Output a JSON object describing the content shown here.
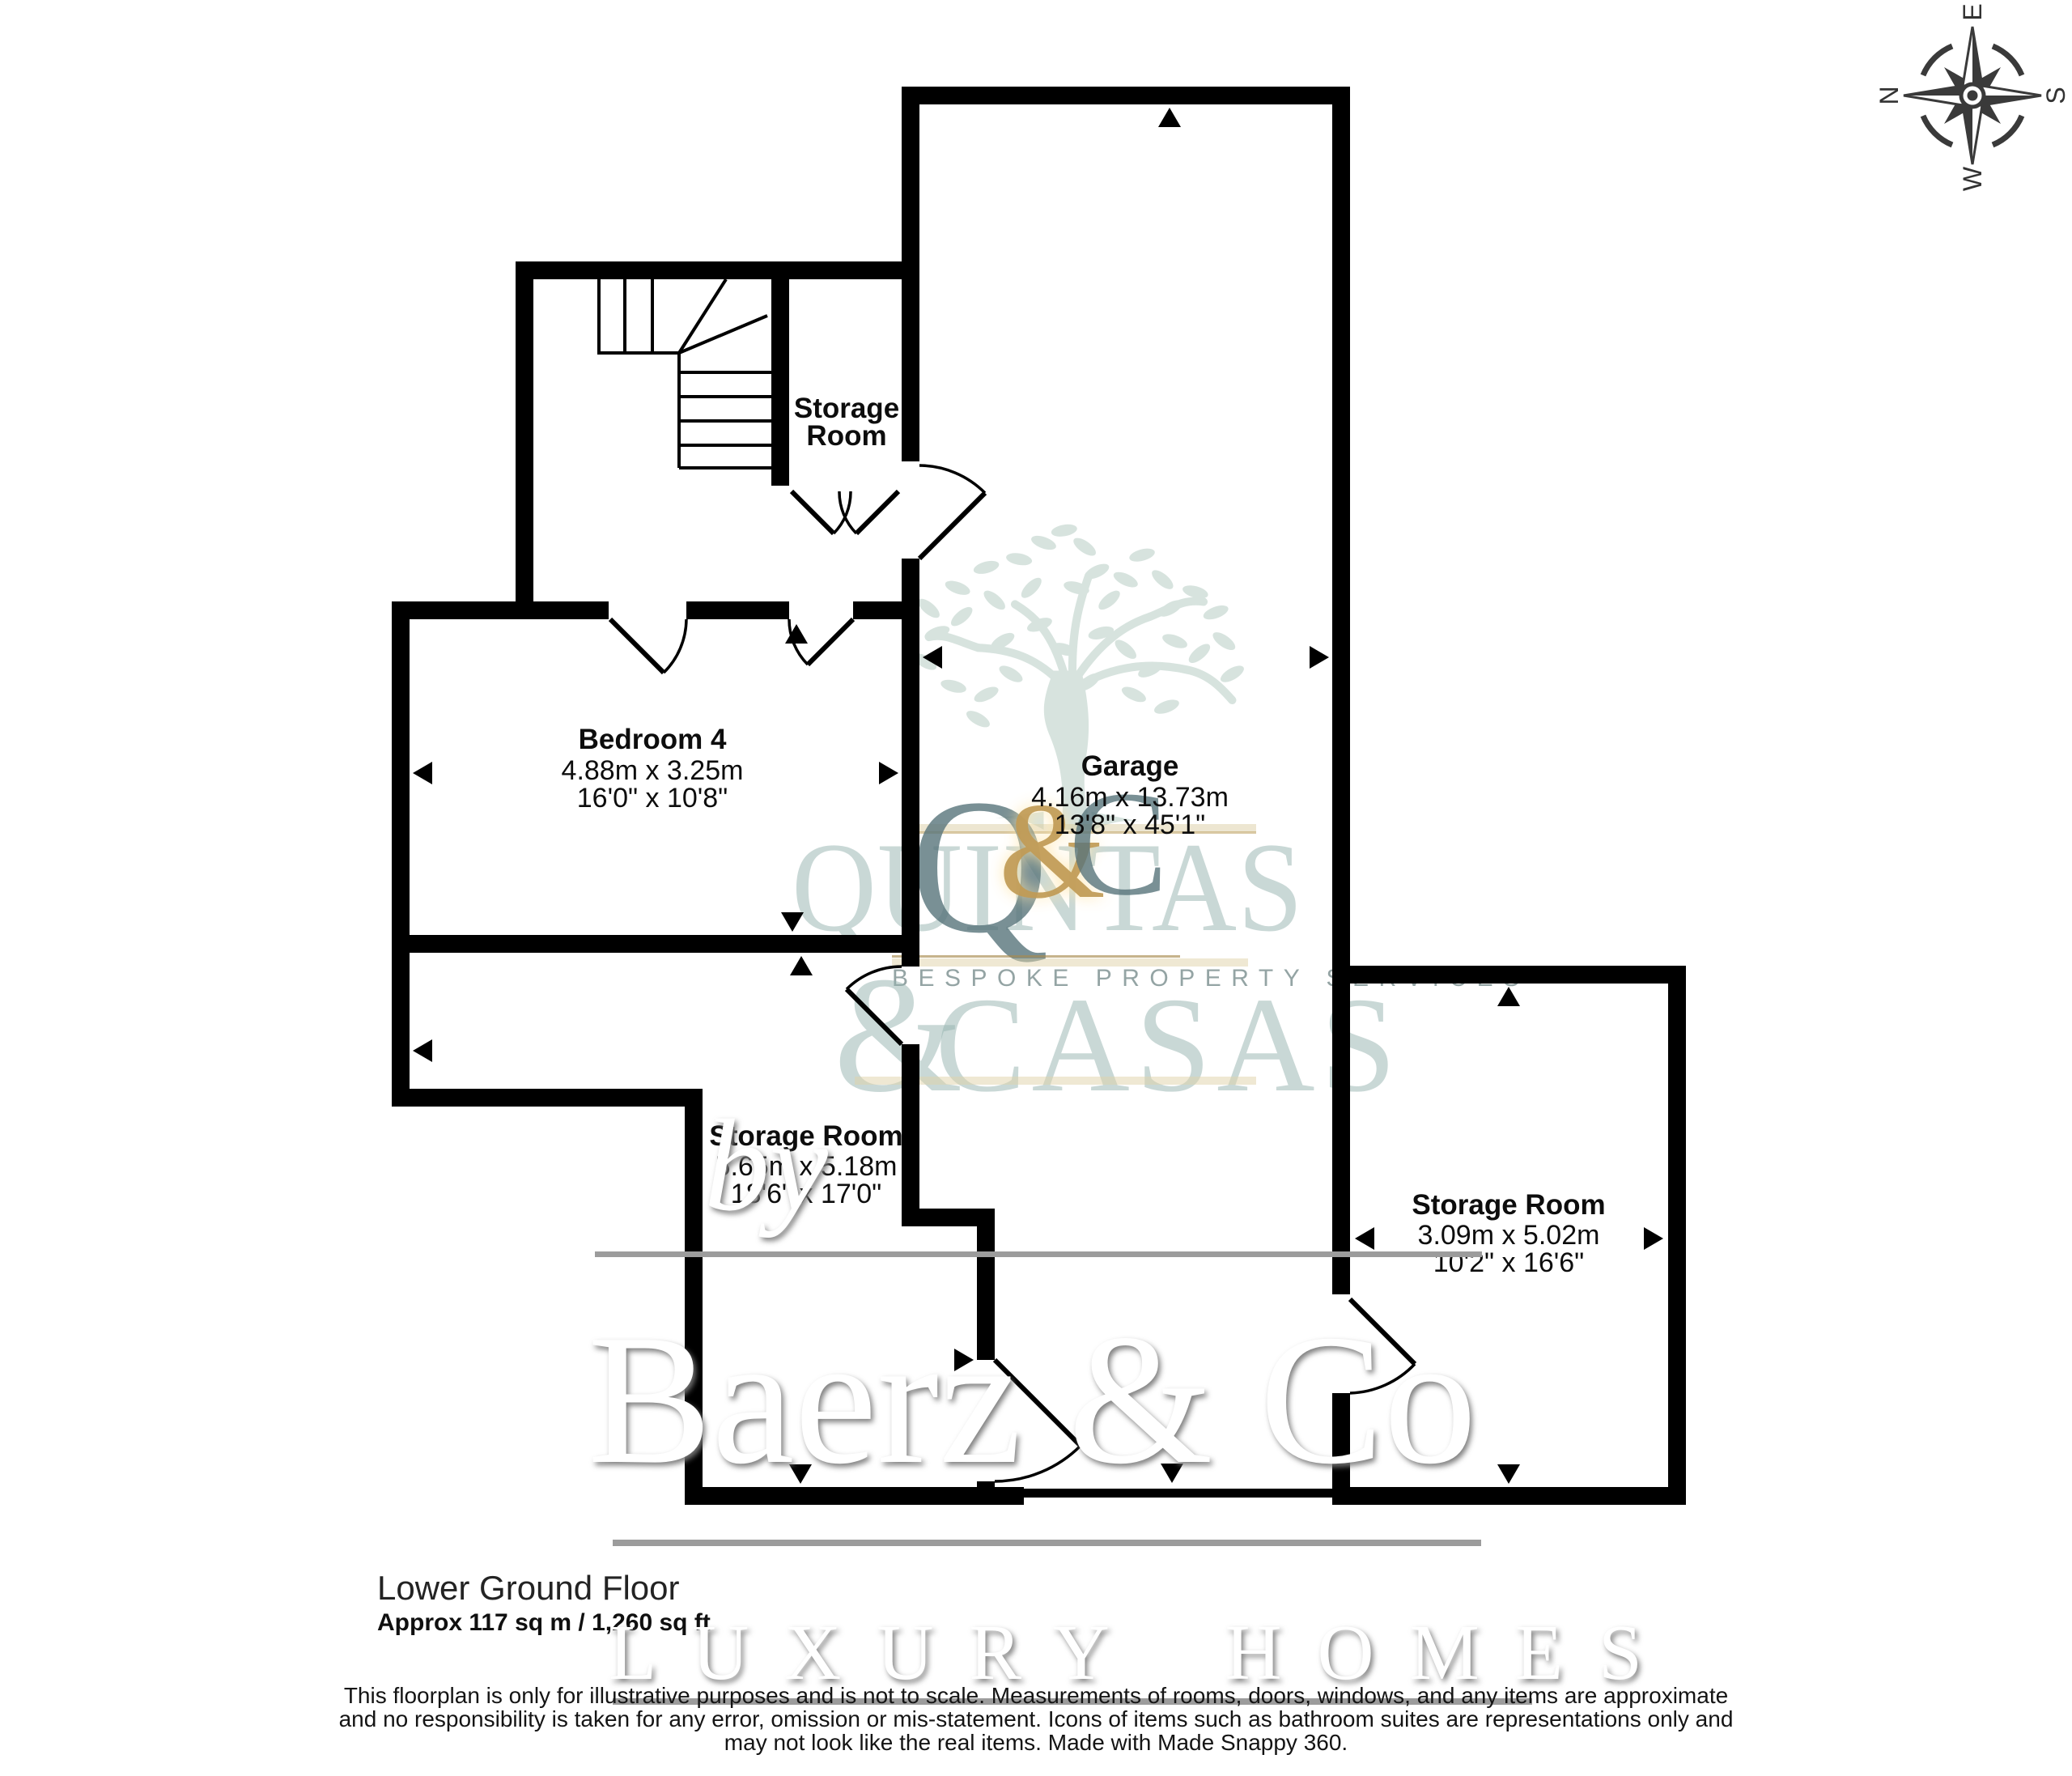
{
  "plan": {
    "floor_title": "Lower Ground Floor",
    "floor_area": "Approx 117 sq m / 1,260 sq ft"
  },
  "rooms": {
    "storage_top": {
      "line1": "Storage",
      "line2": "Room"
    },
    "bedroom4": {
      "name": "Bedroom 4",
      "metric": "4.88m x 3.25m",
      "imperial": "16'0\" x 10'8\""
    },
    "garage": {
      "name": "Garage",
      "metric": "4.16m x 13.73m",
      "imperial": "13'8\" x 45'1\""
    },
    "storage_mid": {
      "name": "Storage Room",
      "metric": "5.65m x 5.18m",
      "imperial": "18'6\" x 17'0\""
    },
    "storage_right": {
      "name": "Storage Room",
      "metric": "3.09m x 5.02m",
      "imperial": "10'2\" x 16'6\""
    }
  },
  "compass": {
    "n": "N",
    "e": "E",
    "s": "S",
    "w": "W"
  },
  "disclaimer": {
    "line1": "This floorplan is only for illustrative purposes and is not to scale. Measurements of rooms, doors, windows, and any items are approximate",
    "line2": "and no responsibility is taken for any error, omission or mis-statement. Icons of items such as bathroom suites are representations only and",
    "line3": "may not look like the real items. Made with Made Snappy 360."
  },
  "watermarks": {
    "agency": {
      "word_top": "QUINTAS",
      "mono_q": "Q",
      "mono_amp": "&",
      "mono_c": "C",
      "tagline": "BESPOKE PROPERTY SERVICES",
      "amp2": "&",
      "word_bottom": "CASAS"
    },
    "broker": {
      "by": "by",
      "name": "Baerz & Co",
      "tagline": "LUXURY HOMES"
    }
  },
  "colors": {
    "wall": "#000000",
    "label_text": "#0d0d0d",
    "agency_teal": "#94b2ae",
    "agency_gold": "#c09a55",
    "tree_teal": "#d5e2dd",
    "broker_white": "#ffffff",
    "rule_gray": "#9c9c9c"
  }
}
